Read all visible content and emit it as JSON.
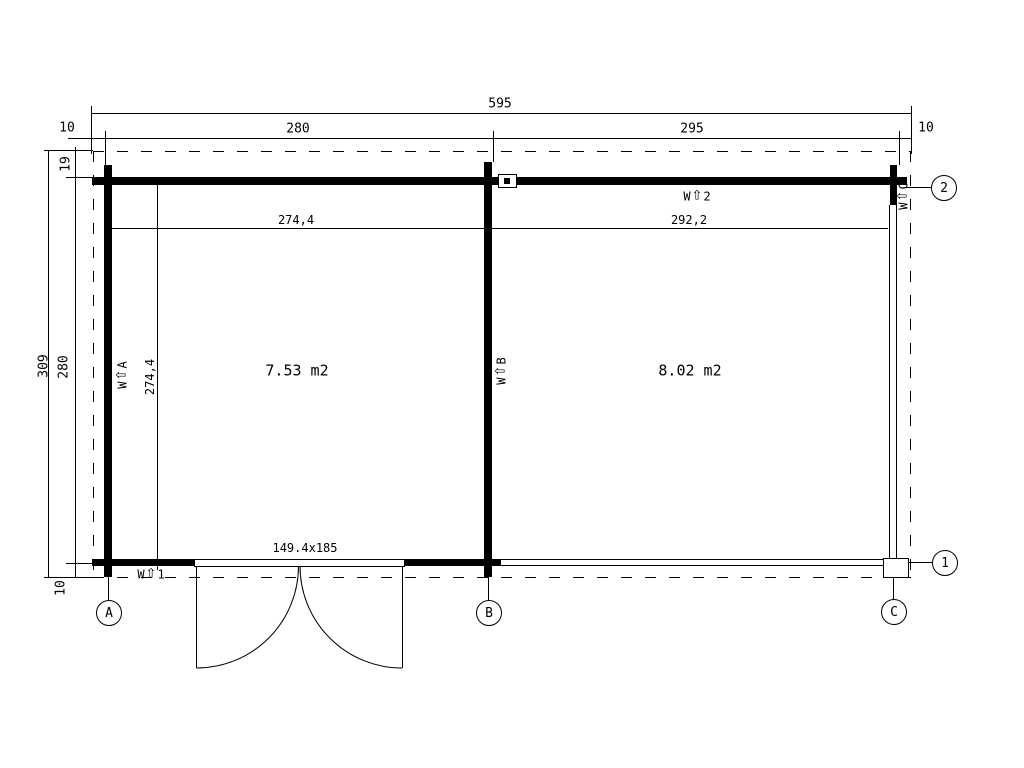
{
  "dims": {
    "total_width": "595",
    "overhang_left": "10",
    "span_ab": "280",
    "span_bc": "295",
    "overhang_right": "10",
    "total_depth": "309",
    "inner_depth": "280",
    "overhang_top": "19",
    "overhang_bottom": "10",
    "room_left_inner_width": "274,4",
    "room_right_inner_width": "292,2",
    "room_inner_depth": "274,4"
  },
  "rooms": {
    "left_area": "7.53 m2",
    "right_area": "8.02 m2"
  },
  "door": {
    "size_label": "149.4x185"
  },
  "icons": {
    "wall_arrow": "⇧"
  },
  "wall_labels": {
    "w2": {
      "prefix": "W",
      "id": "2"
    },
    "w1": {
      "prefix": "W",
      "id": "1"
    },
    "wa": {
      "prefix": "W",
      "id": "A"
    },
    "wb": {
      "prefix": "W",
      "id": "B"
    },
    "wc": {
      "prefix": "W",
      "id": "C"
    }
  },
  "grid_bubbles": {
    "a": "A",
    "b": "B",
    "c": "C",
    "n1": "1",
    "n2": "2"
  }
}
